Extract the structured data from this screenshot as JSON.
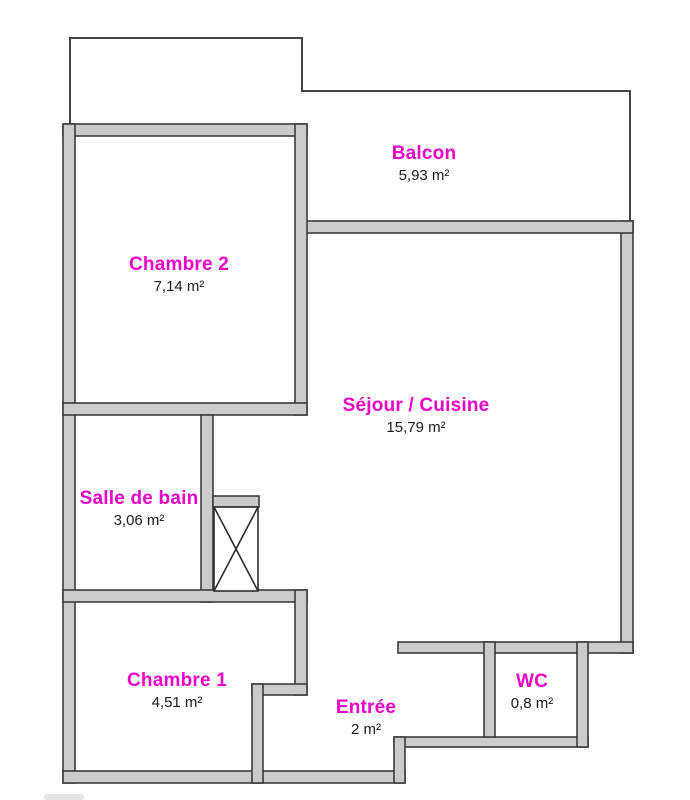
{
  "plan": {
    "title": "Plan d'appartement",
    "rooms": [
      {
        "id": "balcon",
        "name": "Balcon",
        "area": "5,93 m²"
      },
      {
        "id": "chambre2",
        "name": "Chambre 2",
        "area": "7,14 m²"
      },
      {
        "id": "sejour",
        "name": "Séjour / Cuisine",
        "area": "15,79 m²"
      },
      {
        "id": "sdb",
        "name": "Salle de bain",
        "area": "3,06 m²"
      },
      {
        "id": "chambre1",
        "name": "Chambre 1",
        "area": "4,51 m²"
      },
      {
        "id": "entree",
        "name": "Entrée",
        "area": "2 m²"
      },
      {
        "id": "wc",
        "name": "WC",
        "area": "0,8 m²"
      }
    ],
    "colors": {
      "room_label": "#ee00c8",
      "area_text": "#1c1c1c",
      "wall_fill": "#cbcbcb",
      "wall_stroke": "#3c3c3c",
      "thin_line": "#444444"
    }
  }
}
